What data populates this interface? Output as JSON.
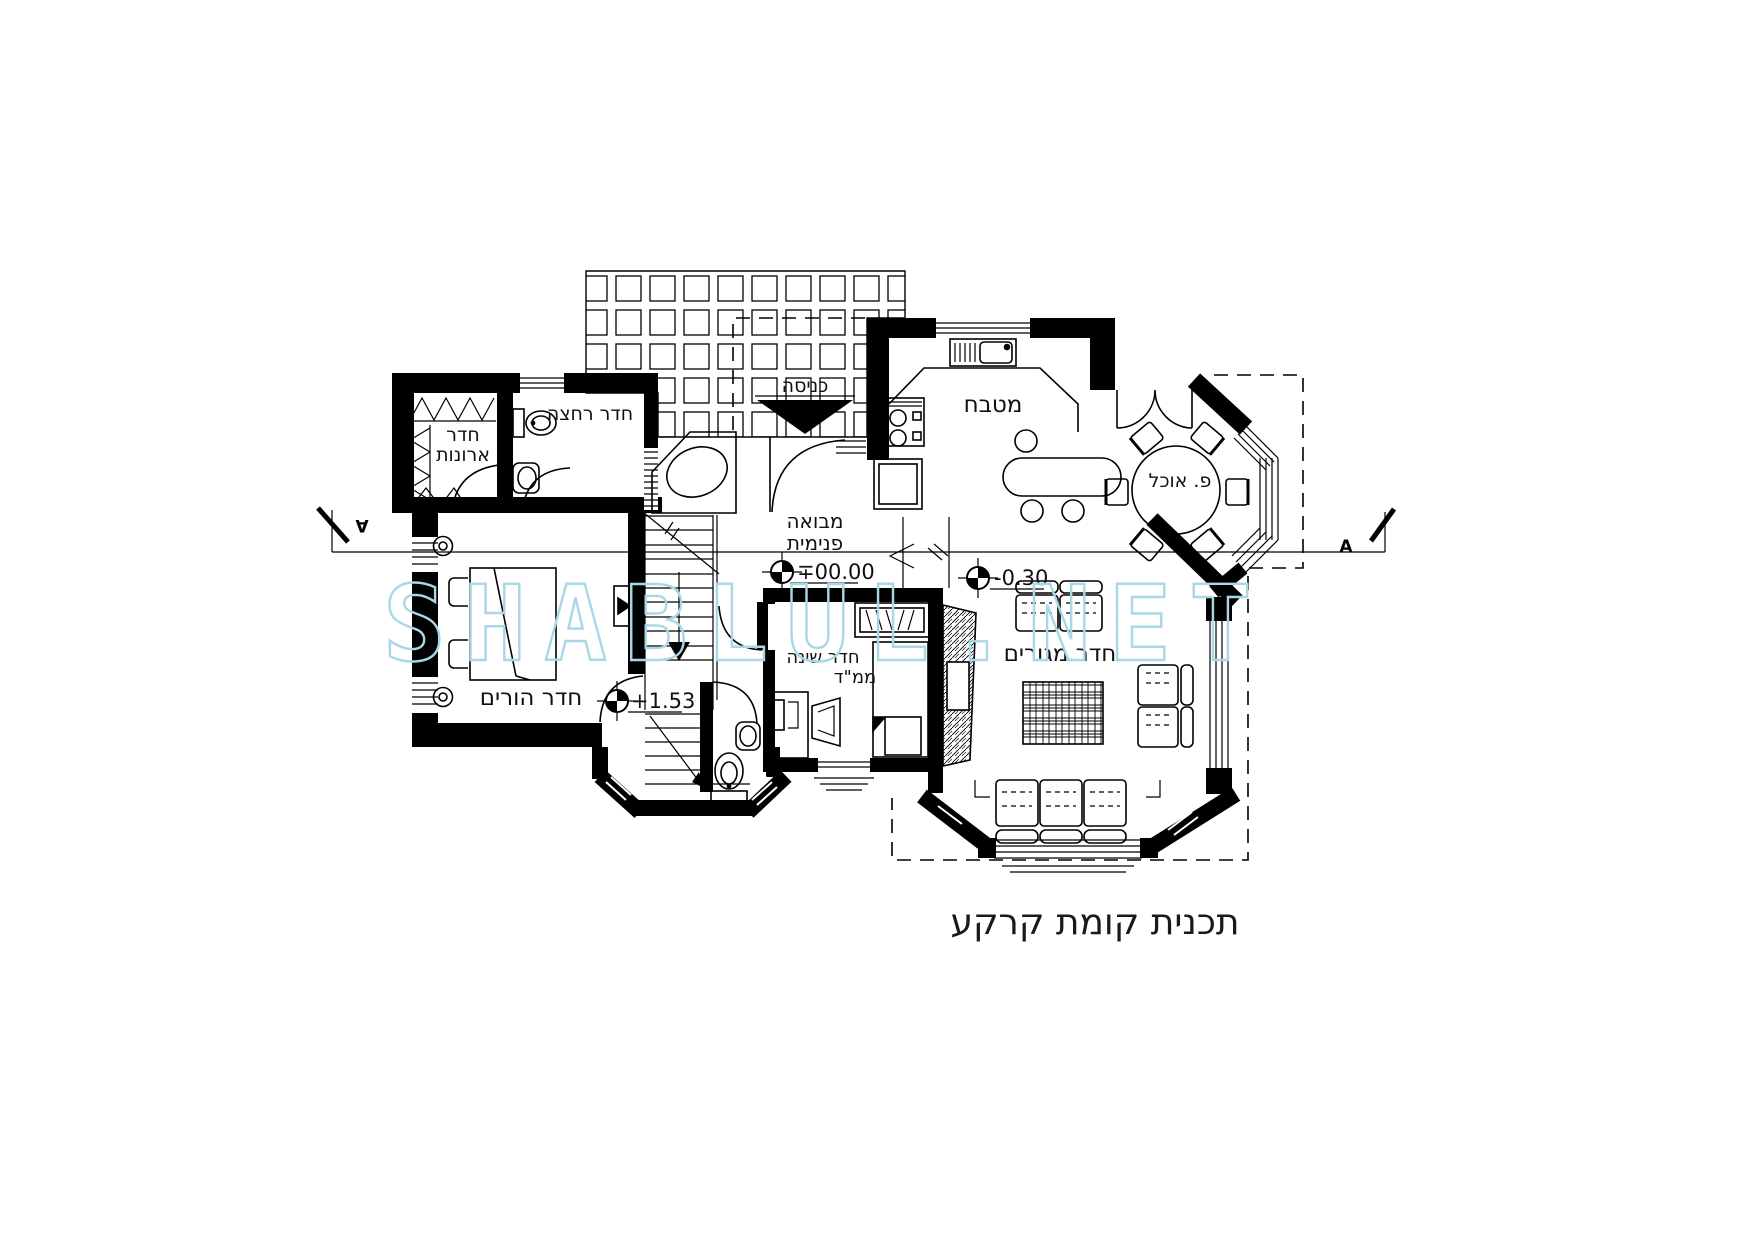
{
  "document": {
    "title": "תכנית קומת קרקע",
    "watermark": "SHABLUL.NET"
  },
  "plan": {
    "rooms": {
      "entrance": "כניסה",
      "kitchen": "מטבח",
      "dining_nook": "פ. אוכל",
      "living_room": "חדר מגורים",
      "parents_room": "חדר הורים",
      "closet_room_line1": "חדר",
      "closet_room_line2": "ארונות",
      "bathroom": "חדר רחצה",
      "foyer_line1": "מבואה",
      "foyer_line2": "פנימית",
      "safe_bedroom_line1": "חדר שינה",
      "safe_bedroom_line2": "ממ\"ד"
    },
    "elevations": {
      "ground": "∓00.00",
      "living": "-0.30",
      "stair_landing": "+1.53"
    },
    "section": {
      "left": "A",
      "right": "A"
    }
  },
  "colors": {
    "ink": "#000000",
    "paper": "#ffffff",
    "watermark": "#a9d7e8"
  }
}
